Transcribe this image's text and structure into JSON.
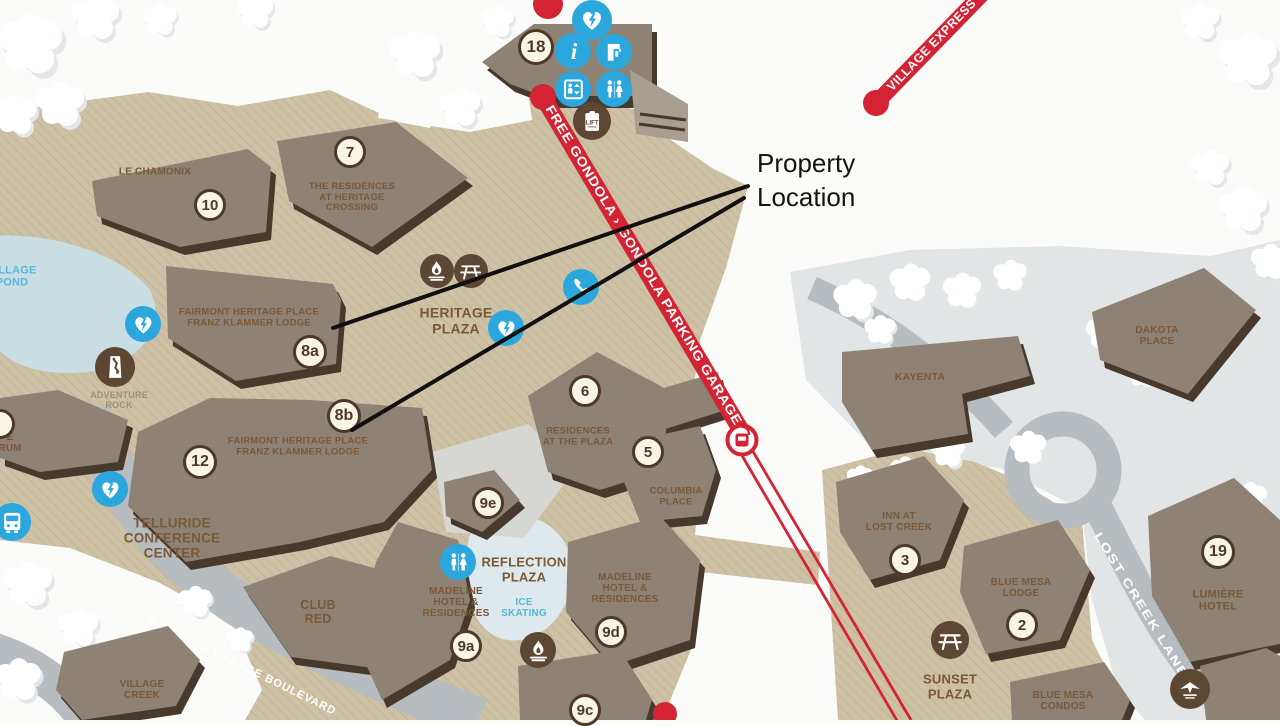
{
  "title": "Telluride Mountain Village Map",
  "annotation": {
    "line1": "Property",
    "line2": "Location"
  },
  "routes": {
    "gondola": "FREE GONDOLA › GONDOLA PARKING GARAGE",
    "village_express": "VILLAGE EXPRESS"
  },
  "roads": {
    "boulevard": "MOUNTAIN VILLAGE BOULEVARD",
    "lost_creek": "LOST CREEK LANE"
  },
  "colors": {
    "tan": "#cdc1a6",
    "tan_line": "#c2b394",
    "snow": "#fbfbfa",
    "gray_area": "#e2e5e5",
    "road": "#b7bcc0",
    "pond": "#c8dee3",
    "ice": "#dde9ed",
    "building": "#8d8273",
    "building_shadow": "#47392c",
    "label_brown": "#7b5836",
    "label_minor": "#a09070",
    "label_blue": "#55b8dc",
    "red": "#d42332",
    "blue_icon": "#2ba7de",
    "brown_icon": "#5d4733",
    "badge_bg": "#f8f4e6",
    "badge_border": "#4c3a26",
    "arrow": "#101010",
    "road_text": "#ffffff"
  },
  "map": {
    "labels": [
      {
        "lines": [
          "LE CHAMONIX"
        ],
        "x": 155,
        "y": 172,
        "size": 10
      },
      {
        "lines": [
          "THE RESIDENCES",
          "AT HERITAGE",
          "CROSSING"
        ],
        "x": 352,
        "y": 198,
        "size": 9.5
      },
      {
        "lines": [
          "FAIRMONT HERITAGE PLACE",
          "FRANZ KLAMMER LODGE"
        ],
        "x": 249,
        "y": 318,
        "size": 9.5
      },
      {
        "lines": [
          "HERITAGE",
          "PLAZA"
        ],
        "x": 456,
        "y": 321,
        "size": 14
      },
      {
        "lines": [
          "ADVENTURE",
          "ROCK"
        ],
        "x": 119,
        "y": 400,
        "cls": "minor",
        "size": 9
      },
      {
        "lines": [
          "FAIRMONT HERITAGE PLACE",
          "FRANZ KLAMMER LODGE"
        ],
        "x": 298,
        "y": 447,
        "size": 9.5
      },
      {
        "lines": [
          "TELLURIDE",
          "CONFERENCE",
          "CENTER"
        ],
        "x": 172,
        "y": 538,
        "size": 13.5
      },
      {
        "lines": [
          "RESIDENCES",
          "AT THE PLAZA"
        ],
        "x": 578,
        "y": 437,
        "size": 9.5
      },
      {
        "lines": [
          "COLUMBIA",
          "PLACE"
        ],
        "x": 676,
        "y": 497,
        "size": 9.5
      },
      {
        "lines": [
          "CLUB",
          "RED"
        ],
        "x": 318,
        "y": 612,
        "size": 12.5
      },
      {
        "lines": [
          "VILLAGE",
          "CREEK"
        ],
        "x": 142,
        "y": 690,
        "size": 10
      },
      {
        "lines": [
          "MADELINE",
          "HOTEL &",
          "RESIDENCES"
        ],
        "x": 456,
        "y": 603,
        "size": 10
      },
      {
        "lines": [
          "REFLECTION",
          "PLAZA"
        ],
        "x": 524,
        "y": 570,
        "size": 13
      },
      {
        "lines": [
          "ICE",
          "SKATING"
        ],
        "x": 524,
        "y": 608,
        "cls": "blue",
        "size": 10
      },
      {
        "lines": [
          "MADELINE",
          "HOTEL &",
          "RESIDENCES"
        ],
        "x": 625,
        "y": 589,
        "size": 10
      },
      {
        "lines": [
          "KAYENTA"
        ],
        "x": 920,
        "y": 378,
        "size": 10.5
      },
      {
        "lines": [
          "DAKOTA",
          "PLACE"
        ],
        "x": 1157,
        "y": 336,
        "size": 10
      },
      {
        "lines": [
          "INN AT",
          "LOST CREEK"
        ],
        "x": 899,
        "y": 522,
        "size": 10
      },
      {
        "lines": [
          "BLUE MESA",
          "LODGE"
        ],
        "x": 1021,
        "y": 588,
        "size": 10
      },
      {
        "lines": [
          "SUNSET",
          "PLAZA"
        ],
        "x": 950,
        "y": 687,
        "size": 13
      },
      {
        "lines": [
          "BLUE MESA",
          "CONDOS"
        ],
        "x": 1063,
        "y": 701,
        "size": 10
      },
      {
        "lines": [
          "LUMIÈRE",
          "HOTEL"
        ],
        "x": 1218,
        "y": 601,
        "size": 11
      },
      {
        "lines": [
          "VILLAGE",
          "POND"
        ],
        "x": 12,
        "y": 277,
        "cls": "blue",
        "size": 11
      },
      {
        "lines": [
          "E",
          "RUM"
        ],
        "x": 10,
        "y": 443,
        "size": 10
      }
    ],
    "badges": [
      {
        "text": "18",
        "x": 536,
        "y": 47,
        "r": 18
      },
      {
        "text": "7",
        "x": 350,
        "y": 152,
        "r": 16
      },
      {
        "text": "10",
        "x": 210,
        "y": 205,
        "r": 16
      },
      {
        "text": "8a",
        "x": 310,
        "y": 352,
        "r": 17
      },
      {
        "text": "8b",
        "x": 344,
        "y": 416,
        "r": 17
      },
      {
        "text": "12",
        "x": 200,
        "y": 462,
        "r": 17
      },
      {
        "text": "6",
        "x": 585,
        "y": 391,
        "r": 16
      },
      {
        "text": "5",
        "x": 648,
        "y": 452,
        "r": 16
      },
      {
        "text": "9e",
        "x": 488,
        "y": 503,
        "r": 16
      },
      {
        "text": "9a",
        "x": 466,
        "y": 646,
        "r": 16
      },
      {
        "text": "9d",
        "x": 611,
        "y": 632,
        "r": 16
      },
      {
        "text": "9c",
        "x": 585,
        "y": 710,
        "r": 16
      },
      {
        "text": "3",
        "x": 905,
        "y": 560,
        "r": 16
      },
      {
        "text": "2",
        "x": 1022,
        "y": 625,
        "r": 16
      },
      {
        "text": "19",
        "x": 1218,
        "y": 552,
        "r": 17
      },
      {
        "text": "",
        "x": 0,
        "y": 424,
        "r": 15
      }
    ],
    "icons": [
      {
        "name": "aed-heart-icon",
        "glyph": "aed",
        "x": 592,
        "y": 20,
        "r": 20,
        "color": "blue"
      },
      {
        "name": "info-icon",
        "glyph": "info",
        "x": 573,
        "y": 51,
        "r": 18,
        "color": "blue"
      },
      {
        "name": "drinking-fountain-icon",
        "glyph": "fountain",
        "x": 614,
        "y": 52,
        "r": 18,
        "color": "blue"
      },
      {
        "name": "elevator-icon",
        "glyph": "elevator",
        "x": 573,
        "y": 89,
        "r": 18,
        "color": "blue"
      },
      {
        "name": "restroom-icon",
        "glyph": "restroom",
        "x": 614,
        "y": 89,
        "r": 18,
        "color": "blue"
      },
      {
        "name": "lift-ticket-icon",
        "glyph": "lift",
        "x": 592,
        "y": 121,
        "r": 19,
        "color": "brown"
      },
      {
        "name": "aed-heart-icon",
        "glyph": "aed",
        "x": 143,
        "y": 324,
        "r": 18,
        "color": "blue"
      },
      {
        "name": "aed-heart-icon",
        "glyph": "aed",
        "x": 110,
        "y": 489,
        "r": 18,
        "color": "blue"
      },
      {
        "name": "aed-heart-icon",
        "glyph": "aed",
        "x": 506,
        "y": 328,
        "r": 18,
        "color": "blue"
      },
      {
        "name": "phone-icon",
        "glyph": "phone",
        "x": 581,
        "y": 287,
        "r": 18,
        "color": "blue"
      },
      {
        "name": "restroom-icon",
        "glyph": "restroom",
        "x": 458,
        "y": 562,
        "r": 18,
        "color": "blue"
      },
      {
        "name": "bus-stop-icon",
        "glyph": "bus",
        "x": 12,
        "y": 522,
        "r": 19,
        "color": "blue"
      },
      {
        "name": "fire-pit-icon",
        "glyph": "fire",
        "x": 437,
        "y": 271,
        "r": 17,
        "color": "brown"
      },
      {
        "name": "picnic-table-icon",
        "glyph": "picnic",
        "x": 471,
        "y": 271,
        "r": 17,
        "color": "brown"
      },
      {
        "name": "climbing-wall-icon",
        "glyph": "climb",
        "x": 115,
        "y": 367,
        "r": 20,
        "color": "brown"
      },
      {
        "name": "fire-pit-icon",
        "glyph": "fire",
        "x": 538,
        "y": 650,
        "r": 18,
        "color": "brown"
      },
      {
        "name": "picnic-table-icon",
        "glyph": "picnic",
        "x": 950,
        "y": 640,
        "r": 19,
        "color": "brown"
      },
      {
        "name": "trail-marker-icon",
        "glyph": "trail",
        "x": 1190,
        "y": 689,
        "r": 20,
        "color": "brown"
      }
    ]
  }
}
